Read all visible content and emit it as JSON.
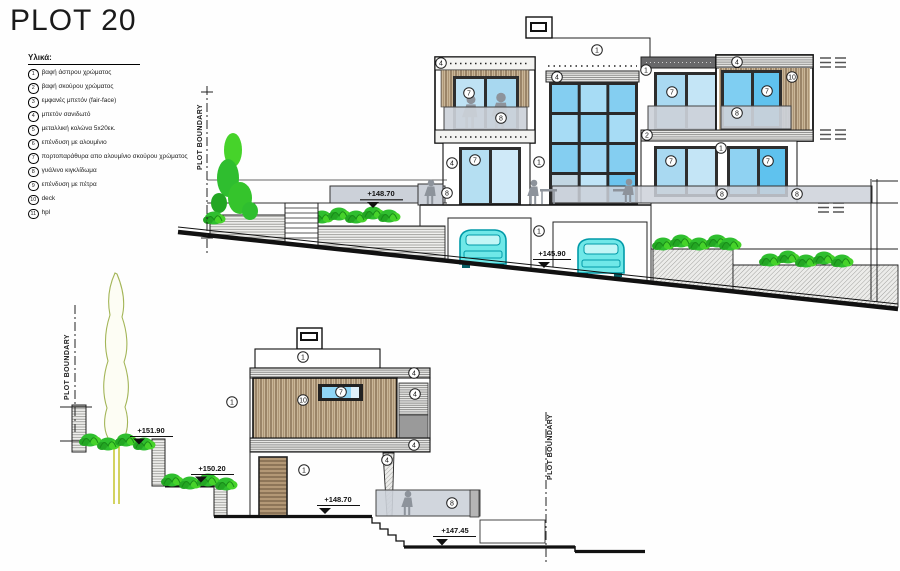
{
  "title": "PLOT 20",
  "legend": {
    "heading": "Υλικά:",
    "items": [
      {
        "num": "1",
        "text": "βαφή άσπρου χρώματος"
      },
      {
        "num": "2",
        "text": "βαφή σκούρου χρώματος"
      },
      {
        "num": "3",
        "text": "εμφανές μπετόν (fair-face)"
      },
      {
        "num": "4",
        "text": "μπετόν σανιδωτό"
      },
      {
        "num": "5",
        "text": "μεταλλική κολώνα 5x20εκ."
      },
      {
        "num": "6",
        "text": "επένδυση με αλουμίνιο"
      },
      {
        "num": "7",
        "text": "πορτοπαράθυρα απο αλουμίνιο σκούρου χρώματος"
      },
      {
        "num": "8",
        "text": "γυάλινο κιγκλίδωμα"
      },
      {
        "num": "9",
        "text": "επένδυση με πέτρα"
      },
      {
        "num": "10",
        "text": "deck"
      },
      {
        "num": "11",
        "text": "hpl"
      }
    ]
  },
  "boundary_label": "PLOT BOUNDARY",
  "levels": {
    "terrace": "+148.70",
    "garage": "+145.90",
    "garden_upper": "+151.90",
    "garden_mid": "+150.20",
    "entrance": "+148.70",
    "path": "+147.45"
  },
  "callouts": {
    "c1": "1",
    "c2": "2",
    "c4": "4",
    "c7": "7",
    "c8": "8",
    "c10": "10"
  },
  "colors": {
    "vegetation_green": "#2fbe2f",
    "glass_blue": "#8ed2f2",
    "wood_brown": "#c9b698",
    "car_cyan": "#6fe8e8",
    "railing_grey": "#ccd1d9",
    "dark_band_grey": "#68686a"
  }
}
